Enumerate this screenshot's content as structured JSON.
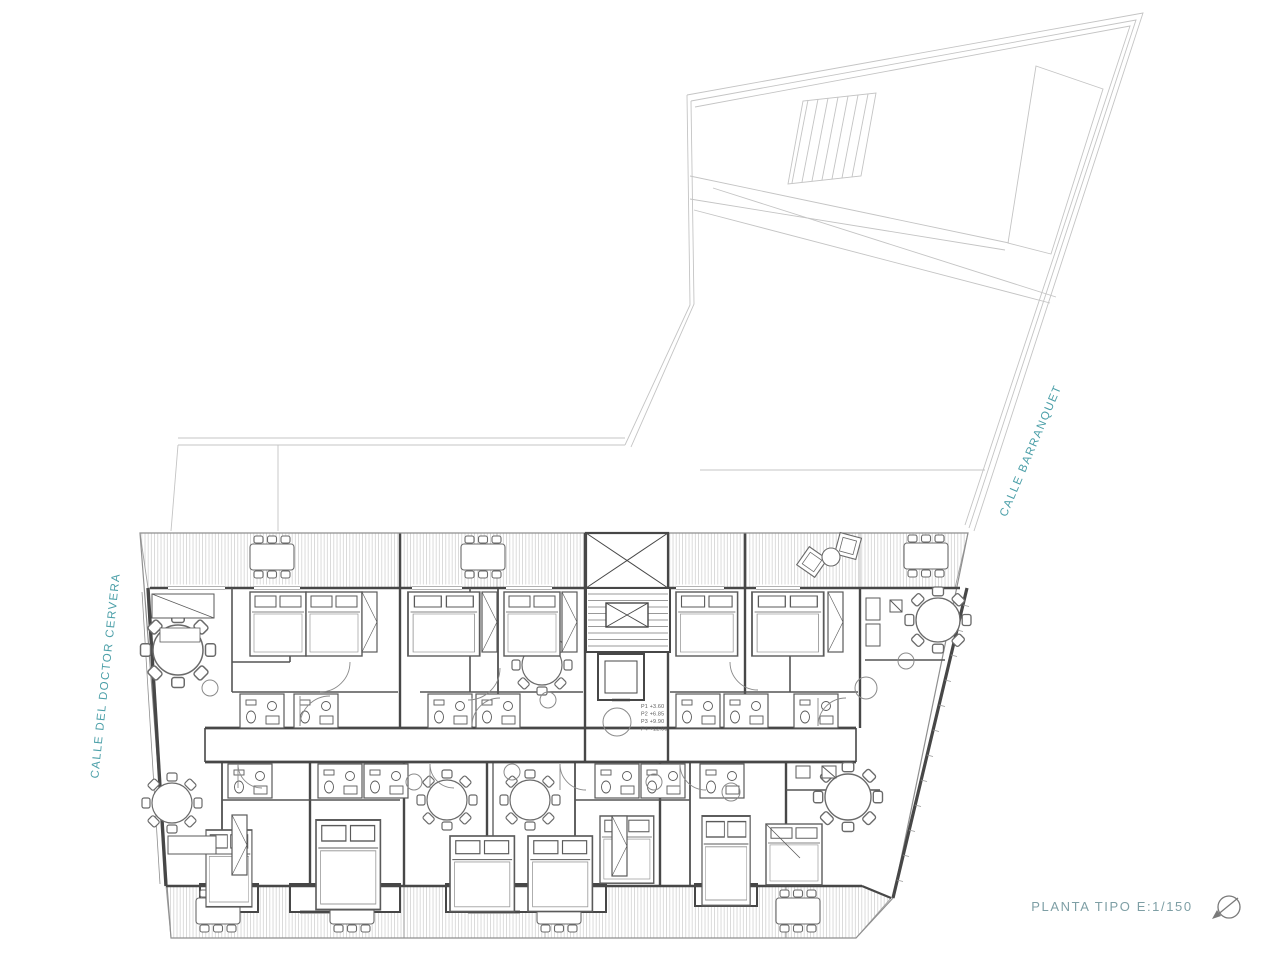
{
  "plan": {
    "title_label": "PLANTA TIPO E:1/150",
    "street_left": "CALLE DEL DOCTOR CERVERA",
    "street_right": "CALLE BARRANQUET",
    "levels": [
      "P1 +3.60",
      "P2 +6.85",
      "P3 +9.90",
      "P4 +12.95"
    ],
    "colors": {
      "accent_teal": "#4B9FA8",
      "title_gray_teal": "#7E9FA5",
      "wall_dark": "#474747",
      "line_light": "#C4C4C4",
      "hatch": "#CDCDCD",
      "paper": "#FFFFFF"
    },
    "icons": {
      "north_arrow": "north-arrow-icon"
    }
  }
}
